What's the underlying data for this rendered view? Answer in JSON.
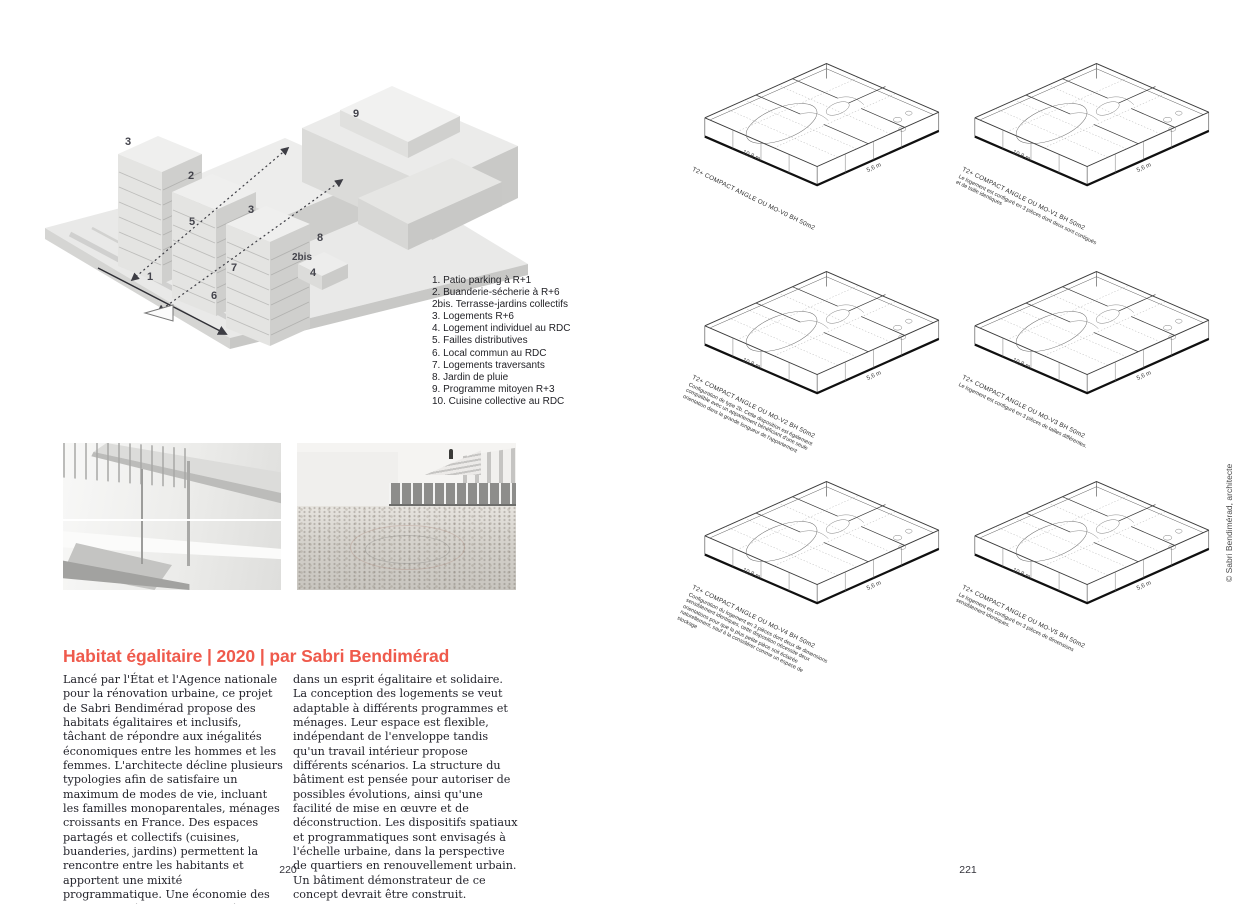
{
  "left_page": {
    "massing_labels": [
      "3",
      "2",
      "9",
      "3",
      "5",
      "8",
      "2bis",
      "7",
      "4",
      "1",
      "6"
    ],
    "legend": [
      "1. Patio parking à R+1",
      "2. Buanderie-sécherie à R+6",
      "2bis. Terrasse-jardins collectifs",
      "3. Logements R+6",
      "4. Logement individuel au RDC",
      "5. Failles distributives",
      "6. Local commun au RDC",
      "7. Logements traversants",
      "8. Jardin de pluie",
      "9. Programme mitoyen R+3",
      "10. Cuisine collective au RDC"
    ],
    "heading": "Habitat égalitaire | 2020 | par Sabri Bendimérad",
    "body_col1": "Lancé par l'État et l'Agence nationale pour la rénovation urbaine, ce projet de Sabri Bendimérad propose des habitats égalitaires et inclusifs, tâchant de répondre aux inégalités économiques entre les hommes et les femmes. L'architecte décline plusieurs typologies afin de satisfaire un maximum de modes de vie, incluant les familles monoparentales, ménages croissants en France. Des espaces partagés et collectifs (cuisines, buanderies, jardins) permettent la rencontre entre les habitants et apportent une mixité programmatique. Une économie des charges est également engagée, toujours",
    "body_col2": "dans un esprit égalitaire et solidaire. La conception des logements se veut adaptable à différents programmes et ménages. Leur espace est flexible, indépendant de l'enveloppe tandis qu'un travail intérieur propose différents scénarios. La structure du bâtiment est pensée pour autoriser de possibles évolutions, ainsi qu'une facilité de mise en œuvre et de déconstruction. Les dispositifs spatiaux et programmatiques sont envisagés à l'échelle urbaine, dans la perspective de quartiers en renouvellement urbain. Un bâtiment démonstrateur de ce concept devrait être construit.",
    "page_number": "220"
  },
  "right_page": {
    "dims": {
      "long": "10,8 m",
      "short": "5,6 m"
    },
    "plans": [
      {
        "title": "T2+ COMPACT ANGLE OU MO-V0 BH 50m2",
        "subtitle": ""
      },
      {
        "title": "T2+ COMPACT ANGLE OU MO-V1 BH 50m2",
        "subtitle": "Le logement est configuré en 3 pièces dont deux sont contiguës et de taille identiques"
      },
      {
        "title": "T2+ COMPACT ANGLE OU MO-V2 BH 50m2",
        "subtitle": "Configuration de type 2b. Cette disposition est également compatible avec un appartement bénéficiant d'une seule orientation dans la grande longueur de l'appartement"
      },
      {
        "title": "T2+ COMPACT ANGLE OU MO-V3 BH 50m2",
        "subtitle": "Le logement est configuré en 3 pièces de tailles différentes."
      },
      {
        "title": "T2+ COMPACT ANGLE OU MO-V4 BH 50m2",
        "subtitle": "Configuration du logement en 3 pièces dont deux de dimensions sensiblement identiques, cette disposition nécessite deux orientations pour que la plus petite pièce soit éclairée naturellement, sauf à la considérer comme un espace de stockage"
      },
      {
        "title": "T2+ COMPACT ANGLE OU MO-V5 BH 50m2",
        "subtitle": "Le logement est configuré en 3 pièces de dimensions sensiblement identiques."
      }
    ],
    "credit": "© Sabri Bendimérad, architecte",
    "page_number": "221"
  },
  "colors": {
    "accent_red": "#ef5a4c",
    "ink": "#23232b",
    "building_gray": "#e4e4e2"
  }
}
